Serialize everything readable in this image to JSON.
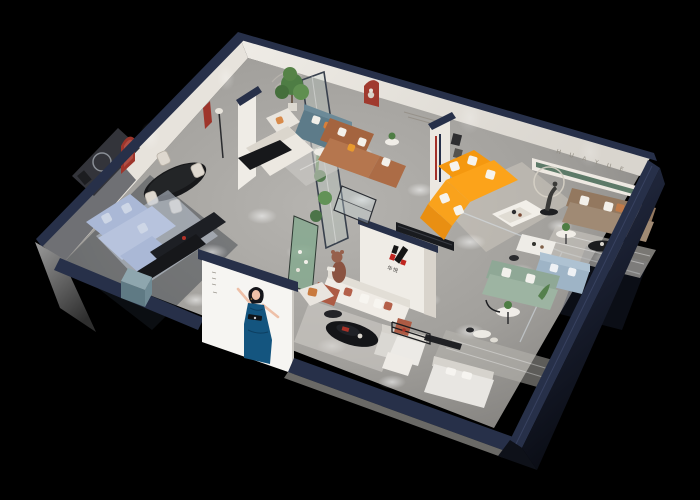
{
  "scene": {
    "description": "3D isometric cutaway dollhouse render of a furniture showroom apartment on a black background",
    "background_color": "#000000"
  },
  "branding": {
    "wall_lettering": "H U A Y U E",
    "logo_caption": "华悦"
  },
  "palette": {
    "wall_top_navy": "#273049",
    "interior_wall": "#e9e5de",
    "floor_gray": "#a7a5a1",
    "orange_sofa": "#f89c1c",
    "teal_sofa": "#5d7b89",
    "brown_sofa": "#ad6a45",
    "blue_sofa": "#aebad6",
    "green_sofa": "#97ae9c",
    "taupe_sofa": "#9c8570",
    "terracotta_sofa_frame": "#b05c44",
    "niche_red": "#9e352b",
    "poster_dress_blue": "#14557f",
    "plant_green": "#4e7d44"
  },
  "rooms": [
    "blue sofa lounge",
    "dining set",
    "teal sofa lounge",
    "brown sofa lounge",
    "orange sofa lounge",
    "taupe sofa lounge",
    "green sofa display",
    "bedroom displays",
    "central brand showroom with H logo wall",
    "glass plant atrium"
  ]
}
